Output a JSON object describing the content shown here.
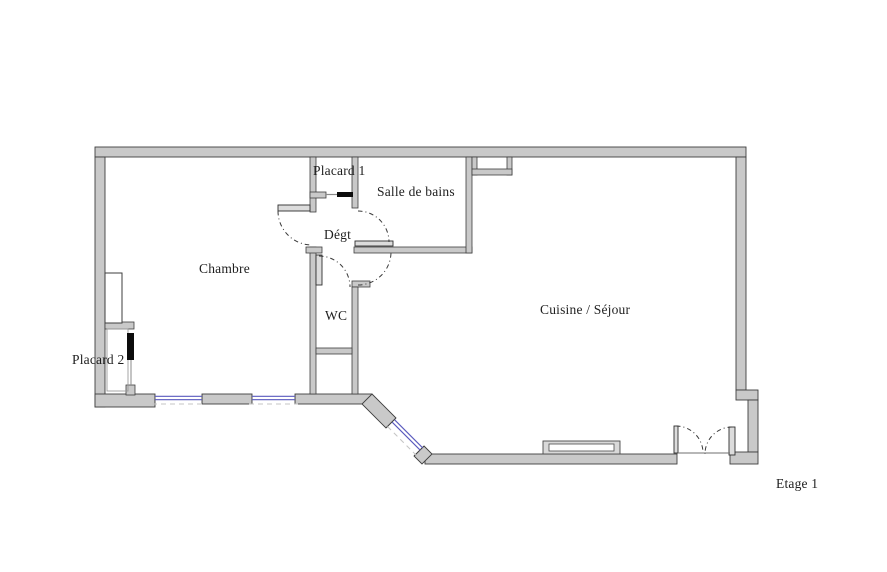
{
  "floorplan": {
    "level_label": "Etage 1",
    "rooms": [
      {
        "id": "placard-1",
        "label": "Placard 1"
      },
      {
        "id": "salle-de-bains",
        "label": "Salle de bains"
      },
      {
        "id": "degt",
        "label": "Dégt"
      },
      {
        "id": "chambre",
        "label": "Chambre"
      },
      {
        "id": "wc",
        "label": "WC"
      },
      {
        "id": "cuisine-sejour",
        "label": "Cuisine / Séjour"
      },
      {
        "id": "placard-2",
        "label": "Placard 2"
      }
    ],
    "colors": {
      "wall_fill": "#c9c9c9",
      "wall_outline": "#3e3e3e",
      "window_glazing": "#5a5abe",
      "door_arc": "#3a3a3a",
      "sliding_door": "#0c0c0c",
      "background": "#ffffff",
      "text": "#1e1e1e"
    }
  }
}
